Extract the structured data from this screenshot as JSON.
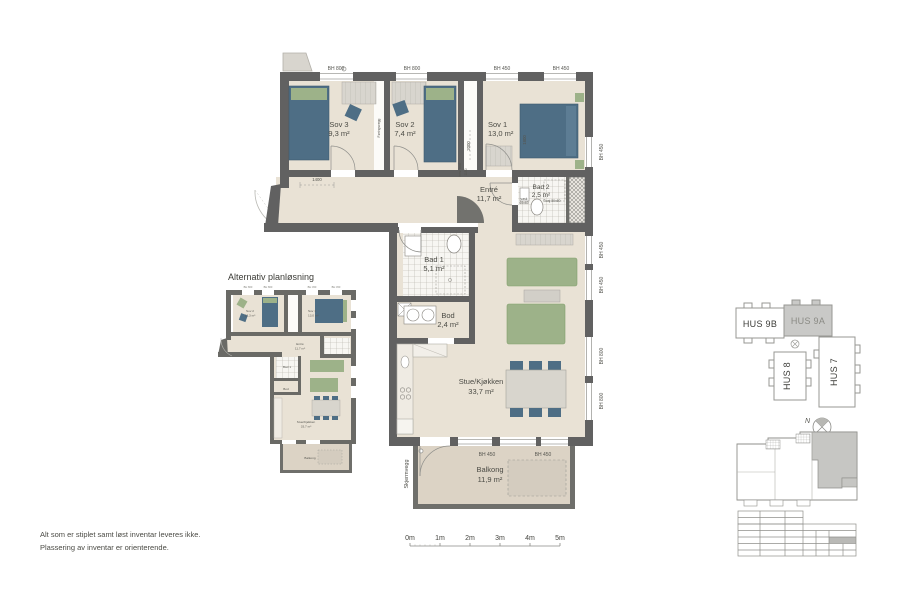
{
  "colors": {
    "wall": "#616161",
    "floor": "#e9e2d5",
    "balcony_floor": "#dcd3c5",
    "furniture_blue": "#4e6e85",
    "furniture_green": "#9db289",
    "wardrobe_grey": "#d8d5ce",
    "highlight_grey": "#c9c9c7"
  },
  "main": {
    "rooms": {
      "sov3": {
        "name": "Sov 3",
        "area": "9,3 m²"
      },
      "sov2": {
        "name": "Sov 2",
        "area": "7,4 m²"
      },
      "sov1": {
        "name": "Sov 1",
        "area": "13,0 m²"
      },
      "entre": {
        "name": "Entré",
        "area": "11,7 m²"
      },
      "bad2": {
        "name": "Bad 2",
        "area": "2,5 m²"
      },
      "bad1": {
        "name": "Bad 1",
        "area": "5,1 m²"
      },
      "bod": {
        "name": "Bod",
        "area": "2,4 m²"
      },
      "stue": {
        "name": "Stue/Kjøkken",
        "area": "33,7 m²"
      },
      "balkong": {
        "name": "Balkong",
        "area": "11,9 m²"
      }
    },
    "dims": {
      "top": [
        "BH 800",
        "BH 800",
        "BH 450",
        "BH 450"
      ],
      "right": [
        "BH 450",
        "BH 450",
        "BH 450",
        "BH 800",
        "BH 800"
      ],
      "balcony": [
        "BH 450",
        "BH 450"
      ],
      "w1400": "1400",
      "h2000": "2000",
      "bod_label": "innv. bod",
      "bod_width": "1150",
      "bed1800": "1800"
    },
    "annotations": {
      "skjermvegg": "Skjermvegg",
      "foringsvegg": "Føringsvegg",
      "vask_label": "vask",
      "vask_size": "60x60",
      "dusj": "Dusj 80x80"
    }
  },
  "alt": {
    "title": "Alternativ planløsning",
    "rooms": {
      "sov2": {
        "name": "Sov 2",
        "area": "12,3 m²"
      },
      "sov1": {
        "name": "Sov 1",
        "area": "13,0 m²"
      },
      "entre": {
        "name": "Entré",
        "area": "11,7 m²"
      },
      "bad1": {
        "name": "Bad 1"
      },
      "bod": {
        "name": "Bod"
      },
      "stue": {
        "name": "Stue/Kjøkken",
        "area": "33,7 m²"
      },
      "balkong": {
        "name": "Balkong"
      }
    },
    "dims_top": [
      "BH 800",
      "BH 800",
      "BH 450",
      "BH 450"
    ]
  },
  "key": {
    "hus9b": "HUS 9B",
    "hus9a": "HUS 9A",
    "hus8": "HUS 8",
    "hus7": "HUS 7",
    "north": "N"
  },
  "scale": {
    "labels": [
      "0m",
      "1m",
      "2m",
      "3m",
      "4m",
      "5m"
    ]
  },
  "notes": {
    "line1": "Alt som er stiplet samt løst inventar leveres ikke.",
    "line2": "Plassering av inventar er orienterende."
  }
}
